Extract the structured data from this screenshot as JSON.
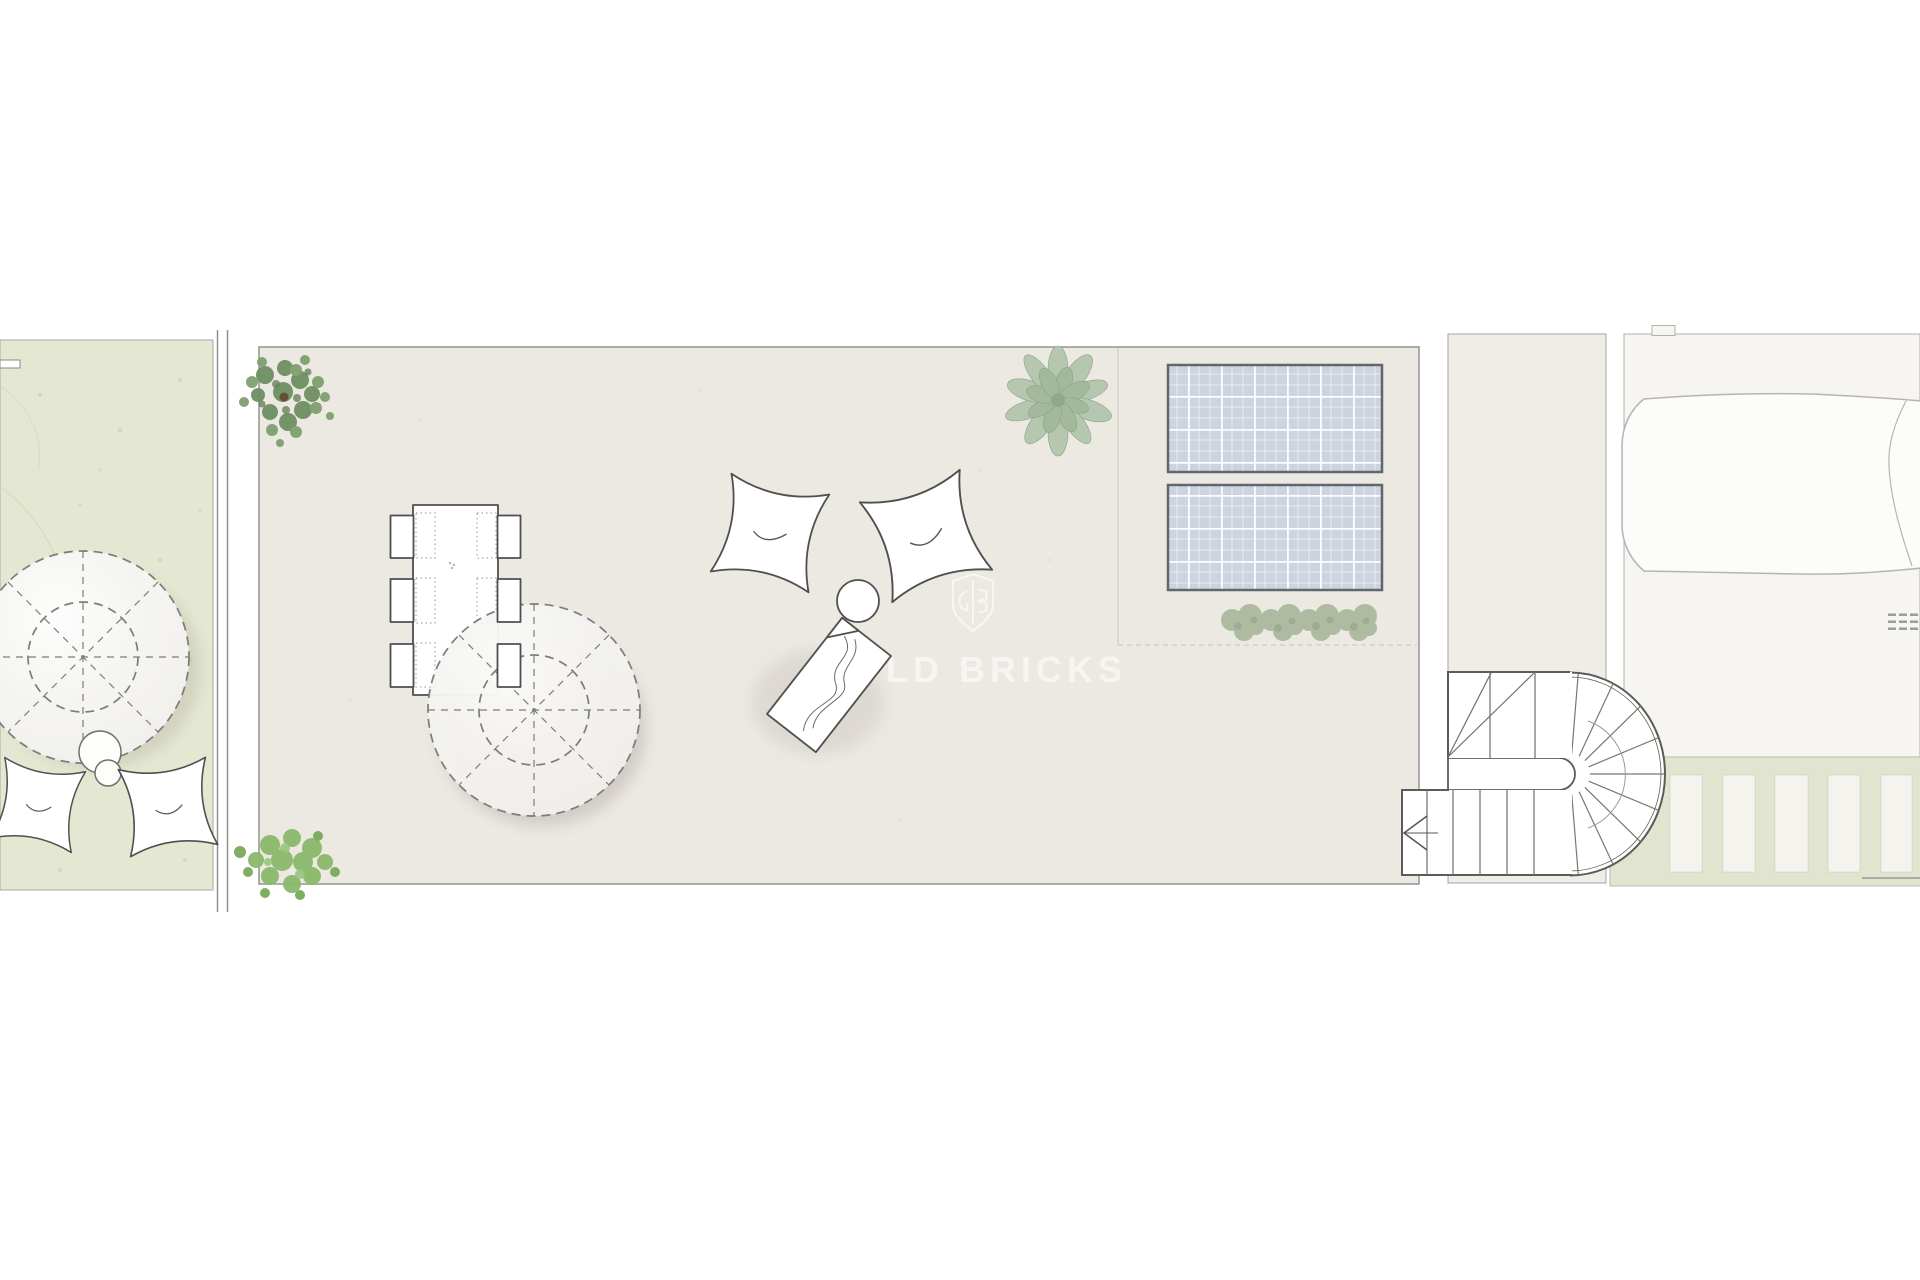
{
  "watermark": {
    "brand": "GOLD BRICKS"
  },
  "colors": {
    "canvas": "#ffffff",
    "garden": "#e4e7d1",
    "terrace": "#ece8e2",
    "corridor": "#f0ede9",
    "pool_area": "#f6f5f2",
    "pool_water": "#fcfcfa",
    "walkway": "#e1e5d0",
    "slat": "#f4f3ee",
    "panel": "#cdd4df",
    "panel_border": "#63666a",
    "line": "#8f8f8b",
    "furniture_stroke": "#4f4f4d",
    "dash_stroke": "#7c7c78",
    "plant_dark": "#6f8f63",
    "plant_bright": "#8ab96a",
    "plant_sage": "#b6c7af",
    "hedge": "#a9b79a",
    "watermark_color": "rgba(255,255,255,0.55)"
  }
}
